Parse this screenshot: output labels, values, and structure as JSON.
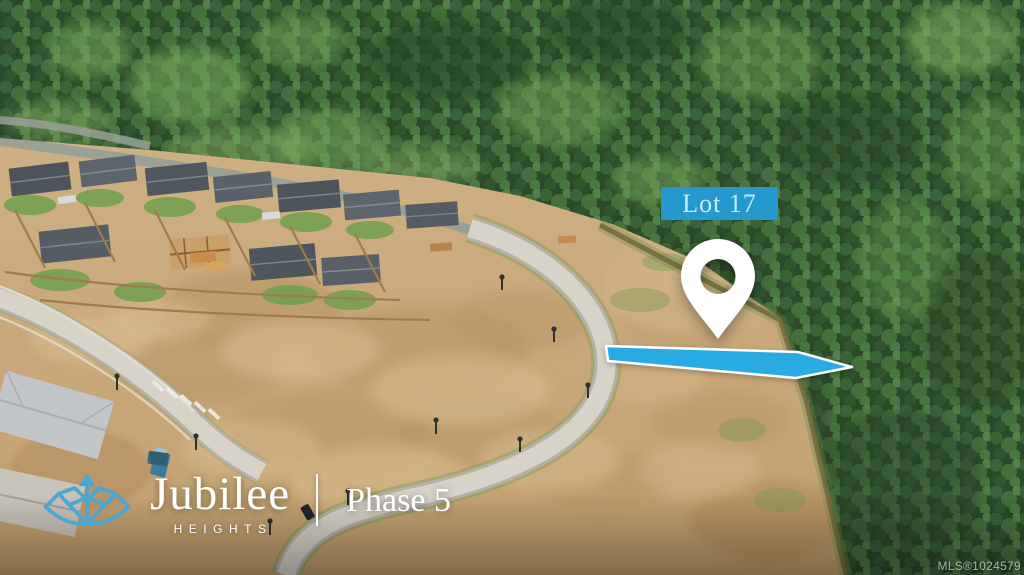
{
  "overlay": {
    "lot_label": "Lot 17",
    "colors": {
      "label_background": "#2598cd",
      "label_text": "#c8ecf9",
      "arrow_fill": "#29abe2",
      "arrow_outline": "#ffffff",
      "pin_fill": "#ffffff",
      "emblem_blue": "#4ba6d2"
    },
    "icons": {
      "map_pin": "map-pin-icon",
      "lot_arrow": "lot-arrow-icon",
      "emblem": "jubilee-emblem-icon"
    }
  },
  "brand": {
    "name": "Jubilee",
    "tagline": "HEIGHTS",
    "phase": "Phase 5"
  },
  "footer": {
    "mls": "MLS®1024579"
  }
}
